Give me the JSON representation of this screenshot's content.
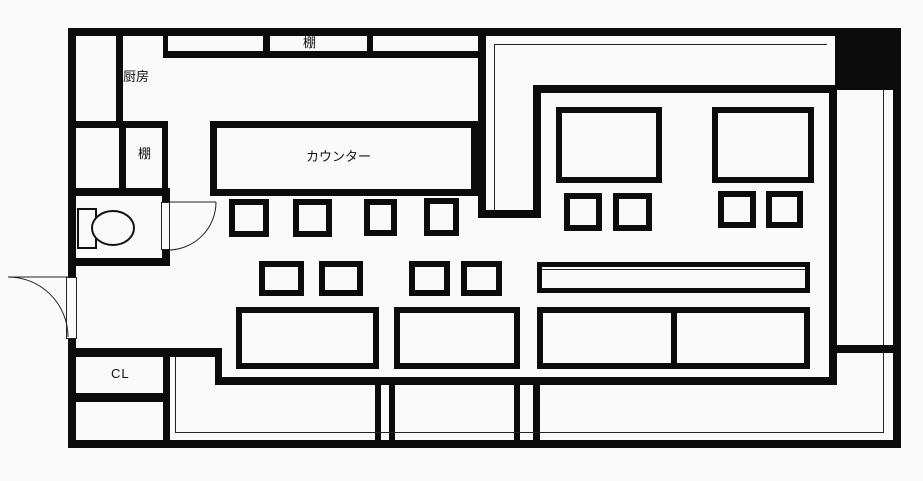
{
  "labels": {
    "shelf_top": "棚",
    "kitchen": "厨房",
    "shelf_side": "棚",
    "counter": "カウンター",
    "closet": "CL"
  },
  "colors": {
    "wall": "#0b0b0b",
    "background": "#fafafa",
    "thin_line": "#222222",
    "pillar_fill": "#000000"
  }
}
